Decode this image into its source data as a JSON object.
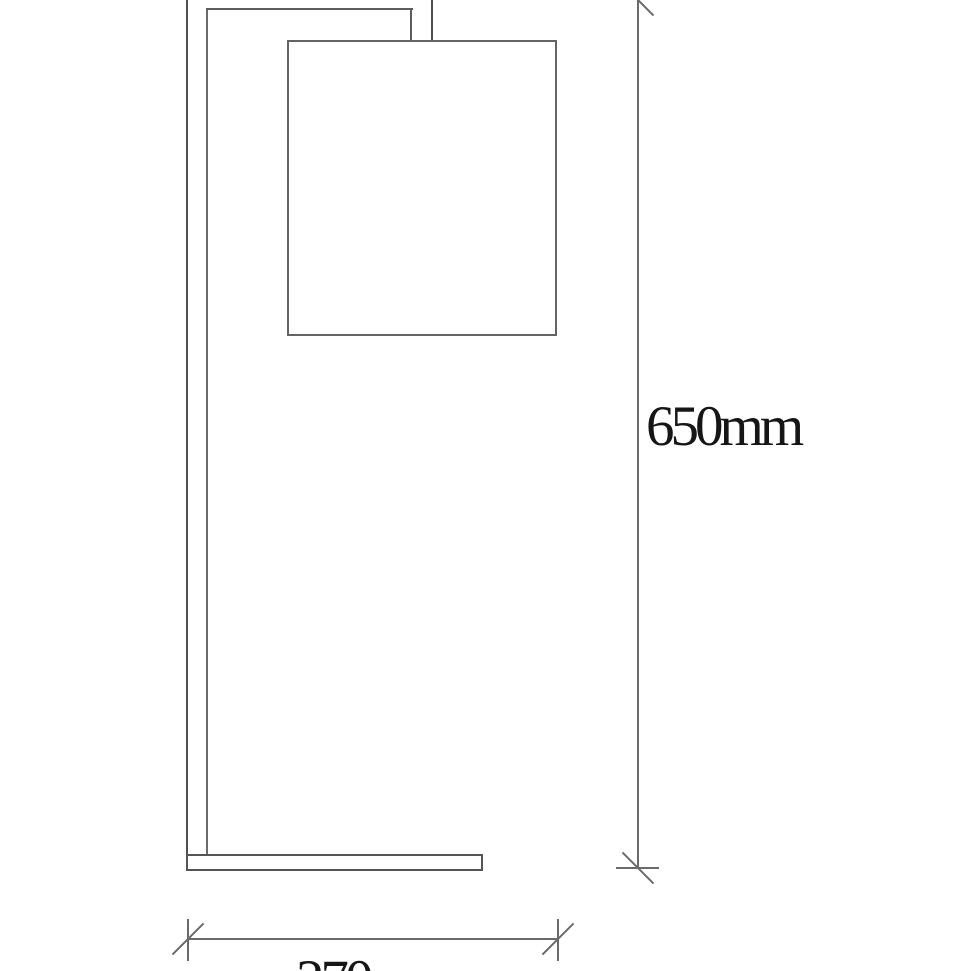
{
  "drawing": {
    "background_color": "#ffffff",
    "structure_line_color": "#4f4f4f",
    "dimension_line_color": "#6a6a6a",
    "label_text_color": "#161616",
    "dimensions": {
      "height": {
        "label": "650mm"
      },
      "depth": {
        "label": "270mm"
      }
    }
  }
}
